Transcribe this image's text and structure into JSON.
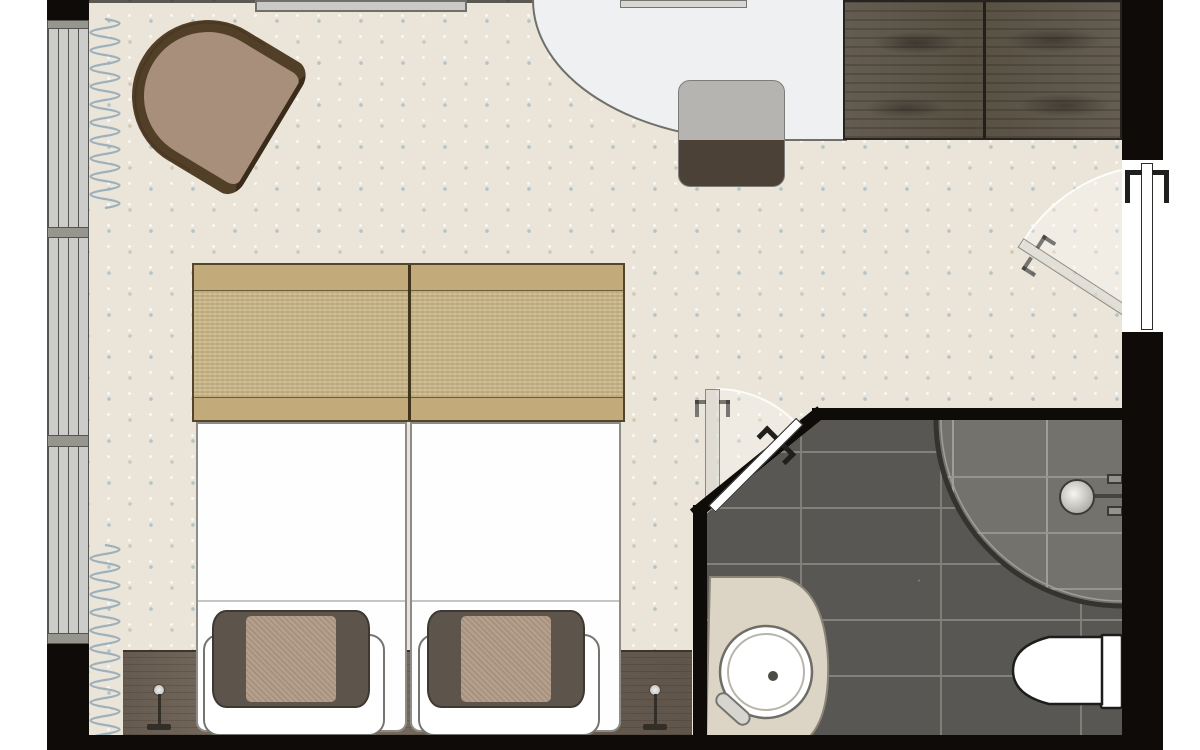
{
  "meta": {
    "type": "architectural-floor-plan",
    "subject": "hotel-guest-room-top-view",
    "visible_text": ""
  },
  "rooms": {
    "bedroom": {
      "furniture": [
        "armchair",
        "wall-tv-panel",
        "wall-shelf-panel",
        "desk",
        "desk-chair",
        "wardrobe",
        "foot-bench",
        "twin-bed-left",
        "twin-bed-right",
        "decorative-pillow-left",
        "decorative-pillow-right",
        "headboard-console",
        "reading-lamp-left",
        "reading-lamp-right",
        "window-band",
        "curtain"
      ]
    },
    "bathroom": {
      "fixtures": [
        "walk-in-shower",
        "curved-glass-screen",
        "shower-head",
        "shower-valves",
        "vanity-counter",
        "round-basin",
        "faucet",
        "toilet"
      ]
    },
    "doors": [
      "entry-door-with-swing",
      "bathroom-door-with-swing"
    ]
  },
  "colors": {
    "outside": "#ffffff",
    "wall": "#0e0b08",
    "carpet": "#ebe5d9",
    "dot_blue": "#b7c4c7",
    "dot_tan": "#d4c8b2",
    "window_glass": "#cccccb",
    "window_bar": "#96968f",
    "frame_line": "#55554f",
    "curtain": "#9db0bb",
    "wood_dark": "#5e564a",
    "console_wood": "#776a5d",
    "bench_band": "#c3aa7b",
    "bench_mid": "#cbb88b",
    "bed_white": "#fefefe",
    "bed_line": "#8d8d88",
    "pillow_dark": "#5d554b",
    "pillow_tan": "#a9927d",
    "chair_rim": "#523f28",
    "chair_seat": "#a78f7b",
    "desk_top": "#eef0f1",
    "desk_line": "#6f6f6b",
    "chair_light": "#b6b4b0",
    "chair_dark": "#4b4137",
    "tv_gray": "#cac9c5",
    "tile_dark": "#595753",
    "tile_grout": "#83817b",
    "tile_light": "#74726c",
    "tile_light_grout": "#96948e",
    "glass_line": "#34332f",
    "vanity": "#dcd5c5",
    "porcelain": "#ffffff",
    "door_leaf": "#ffffff",
    "door_line": "#2b2b28",
    "handle": "#1f1f1d",
    "swing_line": "#ffffff"
  }
}
